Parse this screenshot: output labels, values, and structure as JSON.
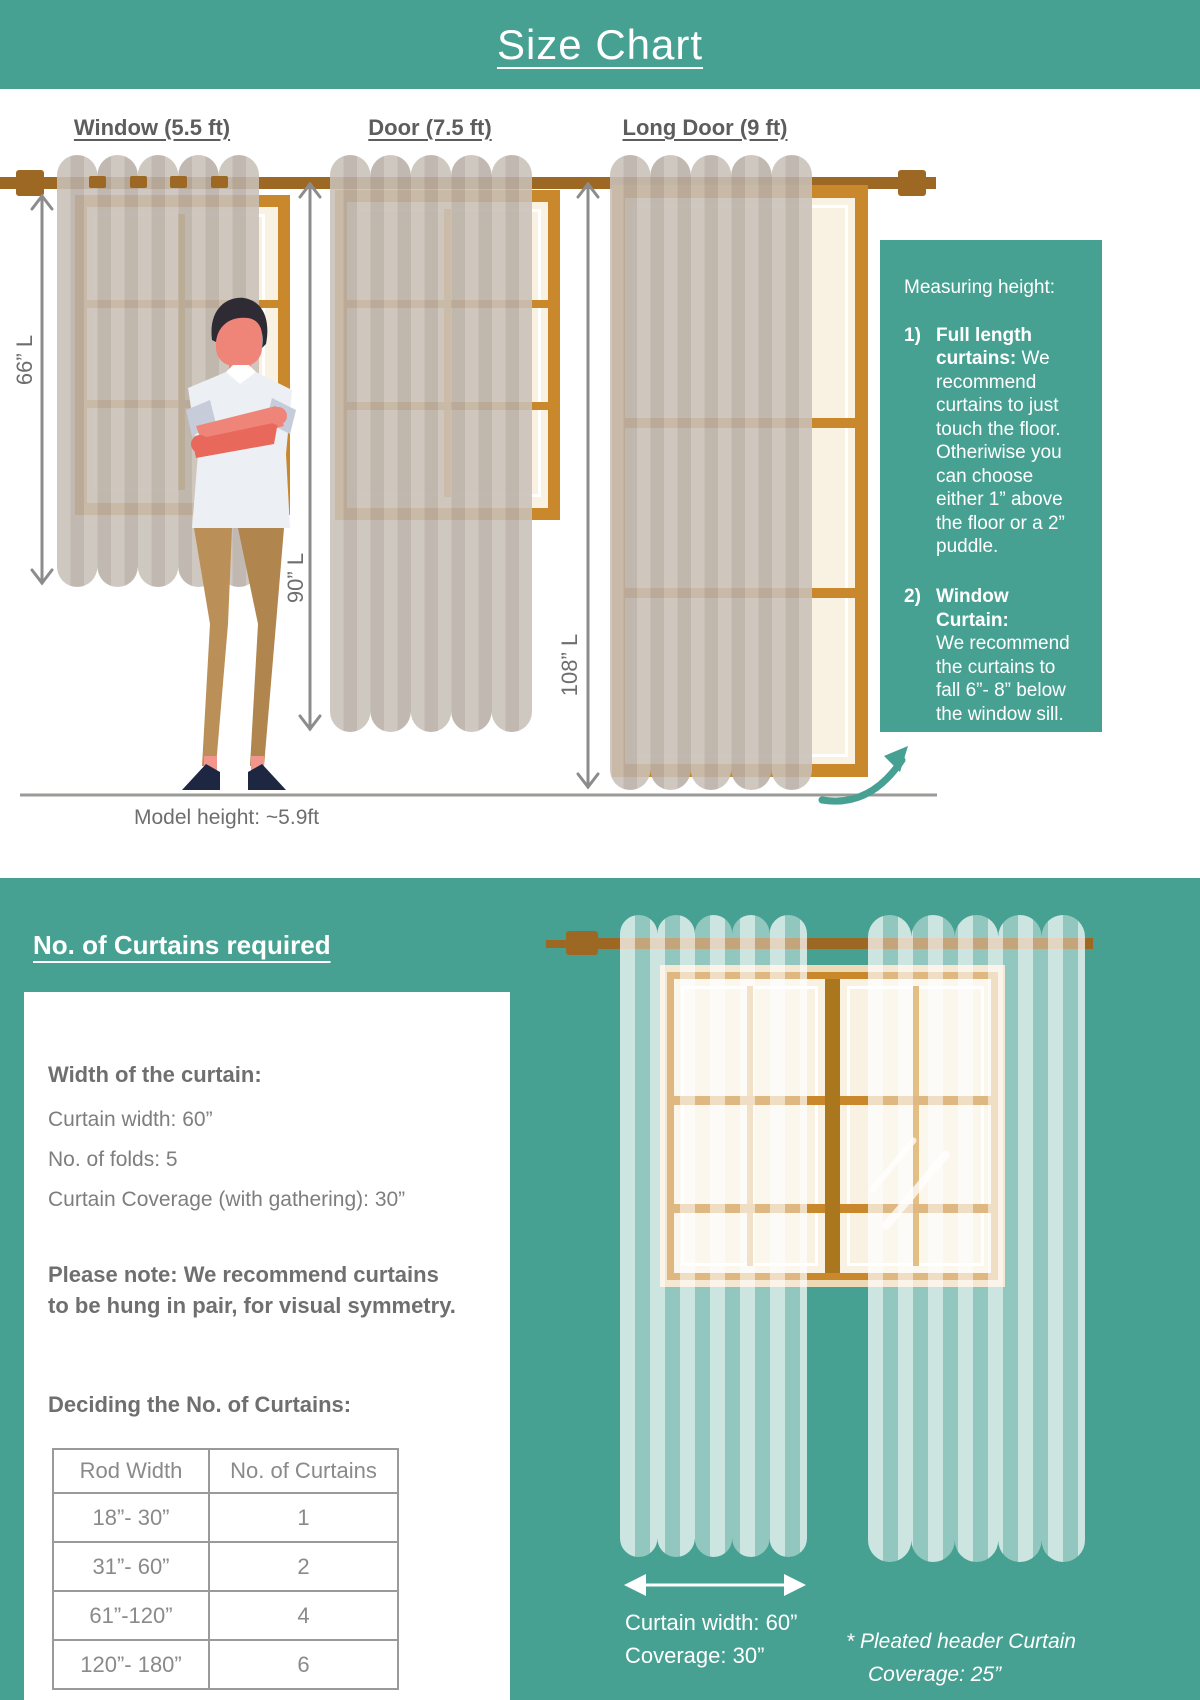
{
  "title": "Size Chart",
  "top": {
    "sections": [
      {
        "label": "Window (5.5 ft)",
        "length": "66” L"
      },
      {
        "label": "Door (7.5 ft)",
        "length": "90” L"
      },
      {
        "label": "Long Door (9 ft)",
        "length": "108” L"
      }
    ],
    "model_height": "Model height: ~5.9ft",
    "info_box": {
      "title": "Measuring height:",
      "item1_num": "1)",
      "item1_bold": "Full length curtains:",
      "item1_rest": " We recommend curtains to just touch the floor. Otheriwise you can choose either 1” above the floor or a 2” puddle.",
      "item2_num": "2)",
      "item2_bold": "Window Curtain:",
      "item2_rest": "We recommend the curtains to fall 6”- 8” below the window sill."
    }
  },
  "bottom": {
    "heading": "No. of Curtains required",
    "card": {
      "width_heading": "Width of the curtain:",
      "line1": "Curtain width: 60”",
      "line2": "No. of folds: 5",
      "line3": "Curtain Coverage (with gathering): 30”",
      "note_line1": "Please note: We recommend curtains",
      "note_line2": "to be hung in pair, for visual symmetry.",
      "table_heading": "Deciding the No. of Curtains:",
      "table": {
        "headers": [
          "Rod Width",
          "No. of Curtains"
        ],
        "rows": [
          [
            "18”- 30”",
            "1"
          ],
          [
            "31”- 60”",
            "2"
          ],
          [
            "61”-120”",
            "4"
          ],
          [
            "120”- 180”",
            "6"
          ]
        ]
      }
    },
    "illustration": {
      "width_line1": "Curtain width: 60”",
      "width_line2": "Coverage: 30”",
      "pleated_line1": "* Pleated header Curtain",
      "pleated_line2": "Coverage: 25”"
    }
  },
  "colors": {
    "teal": "#47a192",
    "rod_brown": "#9c6823",
    "frame_orange": "#c8882b",
    "curtain_taupe": "#c1b8af",
    "text_gray": "#6e6e6e"
  }
}
